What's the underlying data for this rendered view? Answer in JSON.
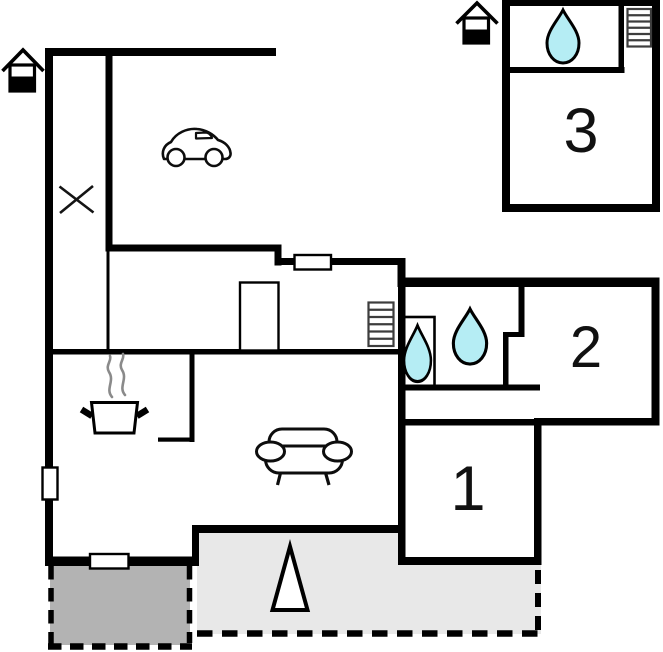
{
  "plan": {
    "type": "floor-plan",
    "rooms": [
      {
        "id": "bedroom-1",
        "label": "1"
      },
      {
        "id": "bedroom-2",
        "label": "2"
      },
      {
        "id": "bedroom-3",
        "label": "3"
      }
    ],
    "icons": [
      "house-entrance-icon",
      "car-icon",
      "x-mark-icon",
      "cooking-pot-icon",
      "steam-icon",
      "sofa-icon",
      "water-drop-icon",
      "stairs-icon",
      "window-marker",
      "tree-triangle-icon"
    ],
    "colors": {
      "wall": "#000000",
      "background": "#ffffff",
      "water_drop_fill": "#b5edf4",
      "terrace_fill": "#e8e8e8",
      "patio_fill": "#b3b3b3",
      "steam": "#8a8a8a",
      "stairs_stroke": "#3d3d3d"
    }
  }
}
